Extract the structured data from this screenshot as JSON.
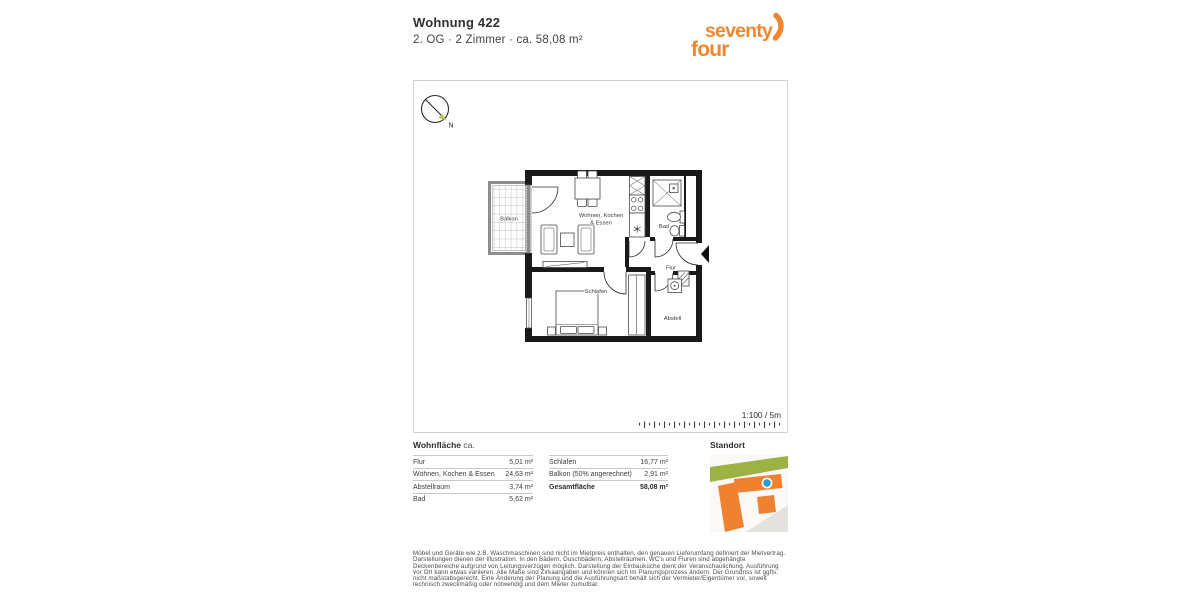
{
  "header": {
    "title": "Wohnung 422",
    "subtitle": "2. OG · 2 Zimmer · ca. 58,08 m²"
  },
  "logo": {
    "line1": "seventy",
    "line2": "four",
    "color": "#f0862e"
  },
  "plan": {
    "compass_label": "N",
    "scale_label": "1:100 / 5m",
    "rooms": {
      "living_line1": "Wohnen, Kochen",
      "living_line2": "& Essen",
      "balcony": "Balkon",
      "bath": "Bad",
      "hall": "Flur",
      "bedroom": "Schlafen",
      "storage": "Abstell"
    }
  },
  "areas": {
    "heading_bold": "Wohnfläche",
    "heading_suffix": "ca.",
    "left": [
      {
        "label": "Flur",
        "value": "5,01 m²"
      },
      {
        "label": "Wohnen, Kochen & Essen",
        "value": "24,63 m²"
      },
      {
        "label": "Abstellraum",
        "value": "3,74 m²"
      },
      {
        "label": "Bad",
        "value": "5,62 m²"
      }
    ],
    "right": [
      {
        "label": "Schlafen",
        "value": "16,77 m²"
      },
      {
        "label": "Balkon (50% angerechnet)",
        "value": "2,91 m²"
      },
      {
        "label": "Gesamtfläche",
        "value": "58,08 m²"
      }
    ]
  },
  "standort": {
    "label": "Standort",
    "map_colors": {
      "building": "#ef8230",
      "green": "#9cb344",
      "marker": "#2f9cd6",
      "street": "#e4e2de"
    }
  },
  "disclaimer": "Möbel und Geräte wie z.B. Waschmaschinen sind nicht im Mietpreis enthalten, den genauen Lieferumfang definiert der Mietvertrag. Darstellungen dienen der Illustration. In den Bädern, Duschbädern, Abstellräumen, WC's und Fluren sind abgehängte Deckenbereiche aufgrund von Leitungsverzügen möglich. Darstellung der Einbauküche dient der Veranschaulichung. Ausführung vor Ort kann etwas variieren. Alle Maße sind Zirkaangaben und können sich im Planungsprozess ändern. Der Grundriss ist ggfls. nicht maßstabsgerecht. Eine Änderung der Planung und die Ausführungsart behält sich der Vermieter/Eigentümer vor, soweit technisch zweckmäßig oder notwendig und dem Mieter zumutbar."
}
